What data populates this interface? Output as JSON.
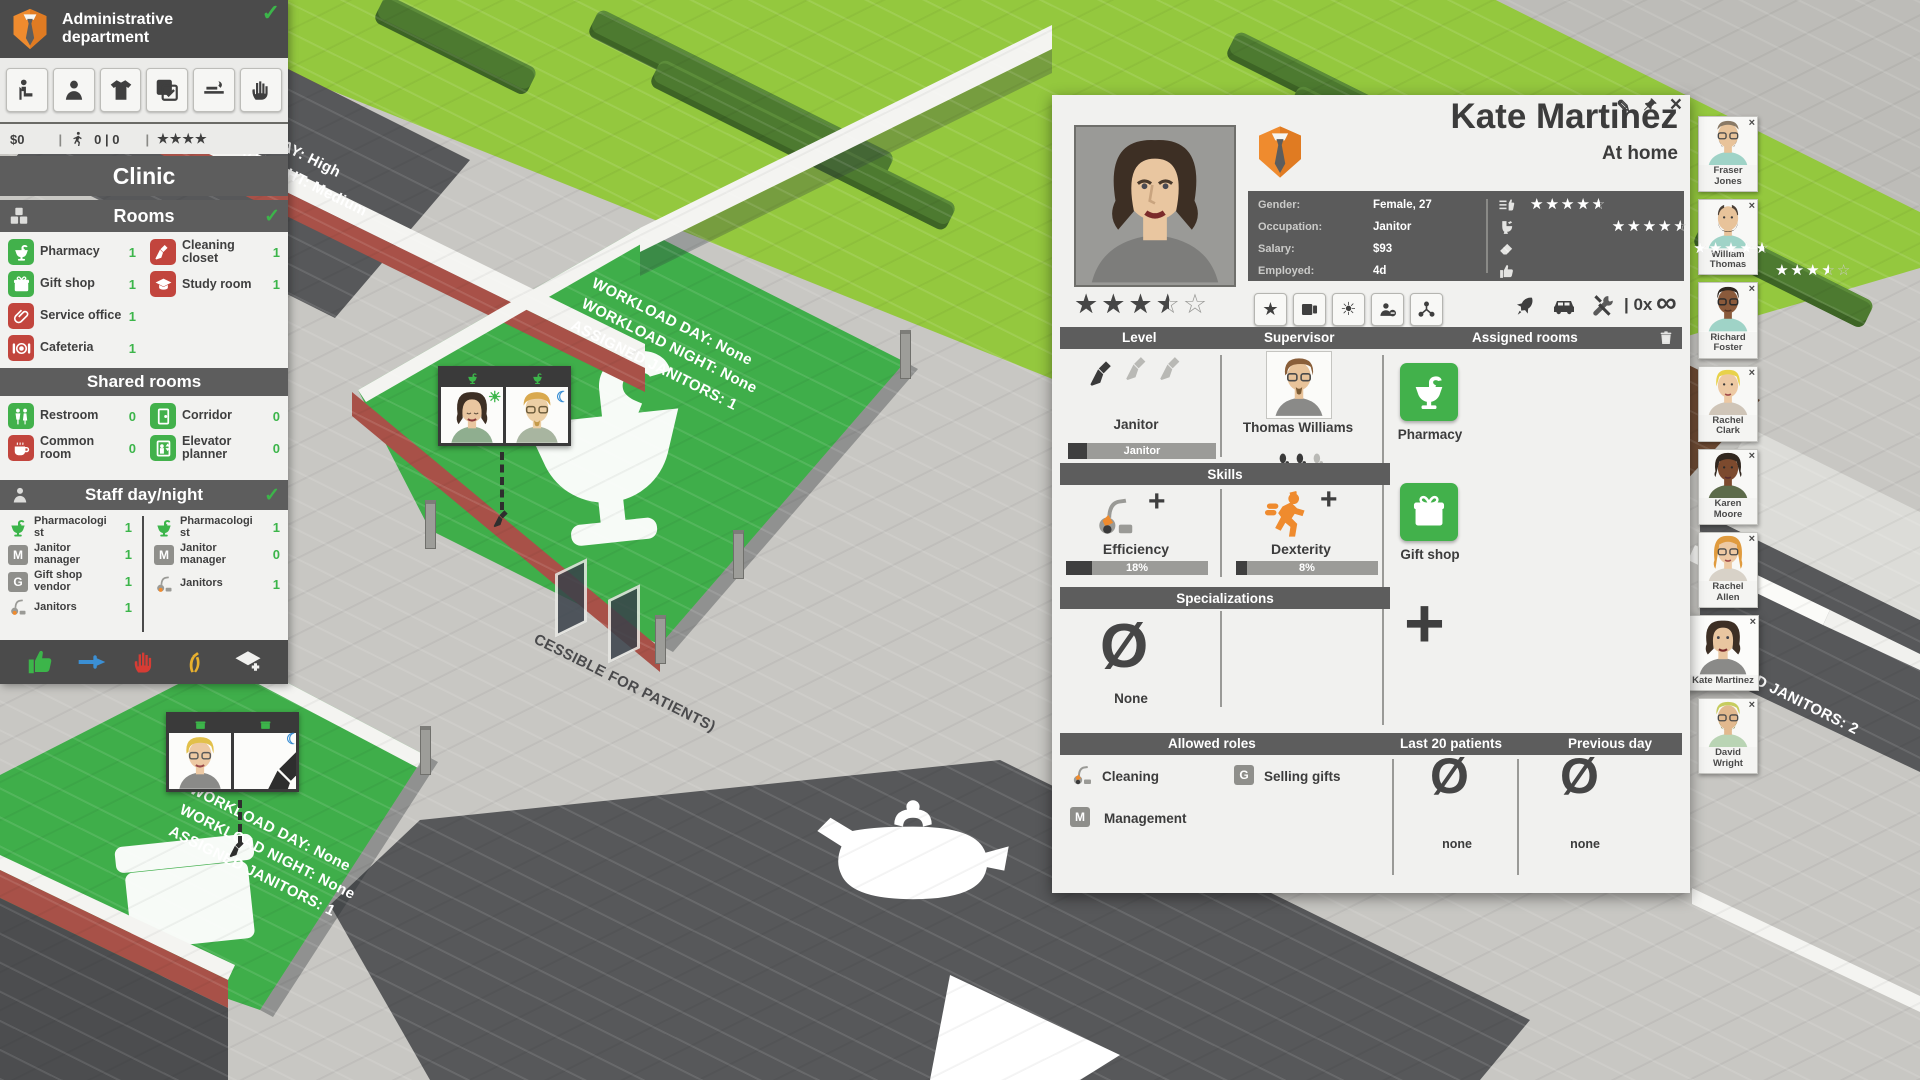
{
  "colors": {
    "accent_green": "#3cb54a",
    "tile_green": "#42b14b",
    "tile_red": "#c2453d",
    "department_orange": "#ef8b2e",
    "panel_dark": "#4b4b4b",
    "section_bar": "#5d5d5d",
    "asphalt": "#57585a",
    "grass": "#94c83e",
    "room_floor_green": "#3fae4a"
  },
  "left_panel": {
    "title": "Administrative department",
    "check": "✓",
    "money": "$0",
    "patients": "0 | 0",
    "stars": "★★★★",
    "sep": "|",
    "clinic": "Clinic",
    "rooms_header": "Rooms",
    "rooms_left": [
      {
        "label": "Pharmacy",
        "count": "1"
      },
      {
        "label": "Gift shop",
        "count": "1"
      },
      {
        "label": "Service office",
        "count": "1"
      },
      {
        "label": "Cafeteria",
        "count": "1"
      }
    ],
    "rooms_right": [
      {
        "label": "Cleaning closet",
        "count": "1"
      },
      {
        "label": "Study room",
        "count": "1"
      }
    ],
    "shared_header": "Shared rooms",
    "shared_left": [
      {
        "label": "Restroom",
        "count": "0"
      },
      {
        "label": "Common room",
        "count": "0"
      }
    ],
    "shared_right": [
      {
        "label": "Corridor",
        "count": "0"
      },
      {
        "label": "Elevator planner",
        "count": "0"
      }
    ],
    "staff_header": "Staff day/night",
    "staff_day": [
      {
        "label": "Pharmacologist",
        "count": "1"
      },
      {
        "label": "Janitor manager",
        "count": "1"
      },
      {
        "label": "Gift shop vendor",
        "count": "1"
      },
      {
        "label": "Janitors",
        "count": "1"
      }
    ],
    "staff_night": [
      {
        "label": "Pharmacologist",
        "count": "1"
      },
      {
        "label": "Janitor manager",
        "count": "0"
      },
      {
        "label": "Janitors",
        "count": "1"
      }
    ]
  },
  "detail": {
    "name": "Kate Martinez",
    "status": "At home",
    "edit_icon": "✎",
    "close_icon": "×",
    "gender_label": "Gender:",
    "gender_value": "Female, 27",
    "occupation_label": "Occupation:",
    "occupation_value": "Janitor",
    "salary_label": "Salary:",
    "salary_value": "$93",
    "employed_label": "Employed:",
    "employed_value": "4d",
    "ratings_values": [
      4.5,
      4.5,
      4.5,
      3.5
    ],
    "overall_value": 3.5,
    "stars_full": "★★★★★",
    "stars_empty": "☆☆☆☆☆",
    "counter": "| 0x",
    "mask_icon": "∞",
    "col_level": "Level",
    "col_supervisor": "Supervisor",
    "col_assigned": "Assigned rooms",
    "level_title": "Janitor",
    "level_bar_label": "Janitor",
    "supervisor_name": "Thomas Williams",
    "assigned": [
      {
        "label": "Pharmacy"
      },
      {
        "label": "Gift shop"
      }
    ],
    "skills_header": "Skills",
    "skills": [
      {
        "label": "Efficiency",
        "value": "18%",
        "pct": 18
      },
      {
        "label": "Dexterity",
        "value": "8%",
        "pct": 8
      }
    ],
    "plus": "+",
    "spec_header": "Specializations",
    "none_symbol": "Ø",
    "spec_none": "None",
    "roles_header": "Allowed roles",
    "last20_header": "Last 20 patients",
    "prev_header": "Previous day",
    "roles": [
      {
        "label": "Cleaning"
      },
      {
        "label": "Selling gifts",
        "badge": "G"
      },
      {
        "label": "Management",
        "badge": "M"
      }
    ],
    "last20_value": "none",
    "prev_value": "none"
  },
  "portraits": [
    {
      "name": "Fraser Jones"
    },
    {
      "name": "William Thomas"
    },
    {
      "name": "Richard Foster"
    },
    {
      "name": "Rachel Clark"
    },
    {
      "name": "Karen Moore"
    },
    {
      "name": "Rachel Allen"
    },
    {
      "name": "Kate Martinez"
    },
    {
      "name": "David Wright"
    }
  ],
  "portrait_close": "×",
  "world": {
    "topleft_1": "WORKLOAD DAY: High",
    "topleft_2": "WORKLOAD NIGHT: Medium",
    "pharmacy_1": "WORKLOAD DAY: None",
    "pharmacy_2": "WORKLOAD NIGHT: None",
    "pharmacy_3": "ASSIGNED JANITORS: 1",
    "gift_1": "WORKLOAD DAY: None",
    "gift_2": "WORKLOAD NIGHT: None",
    "gift_3": "ASSIGNED JANITORS: 1",
    "road_text": "CESSIBLE FOR PATIENTS)",
    "right_text": "NED JANITORS: 2",
    "sun_icon": "☀",
    "moon_icon": "☾"
  }
}
